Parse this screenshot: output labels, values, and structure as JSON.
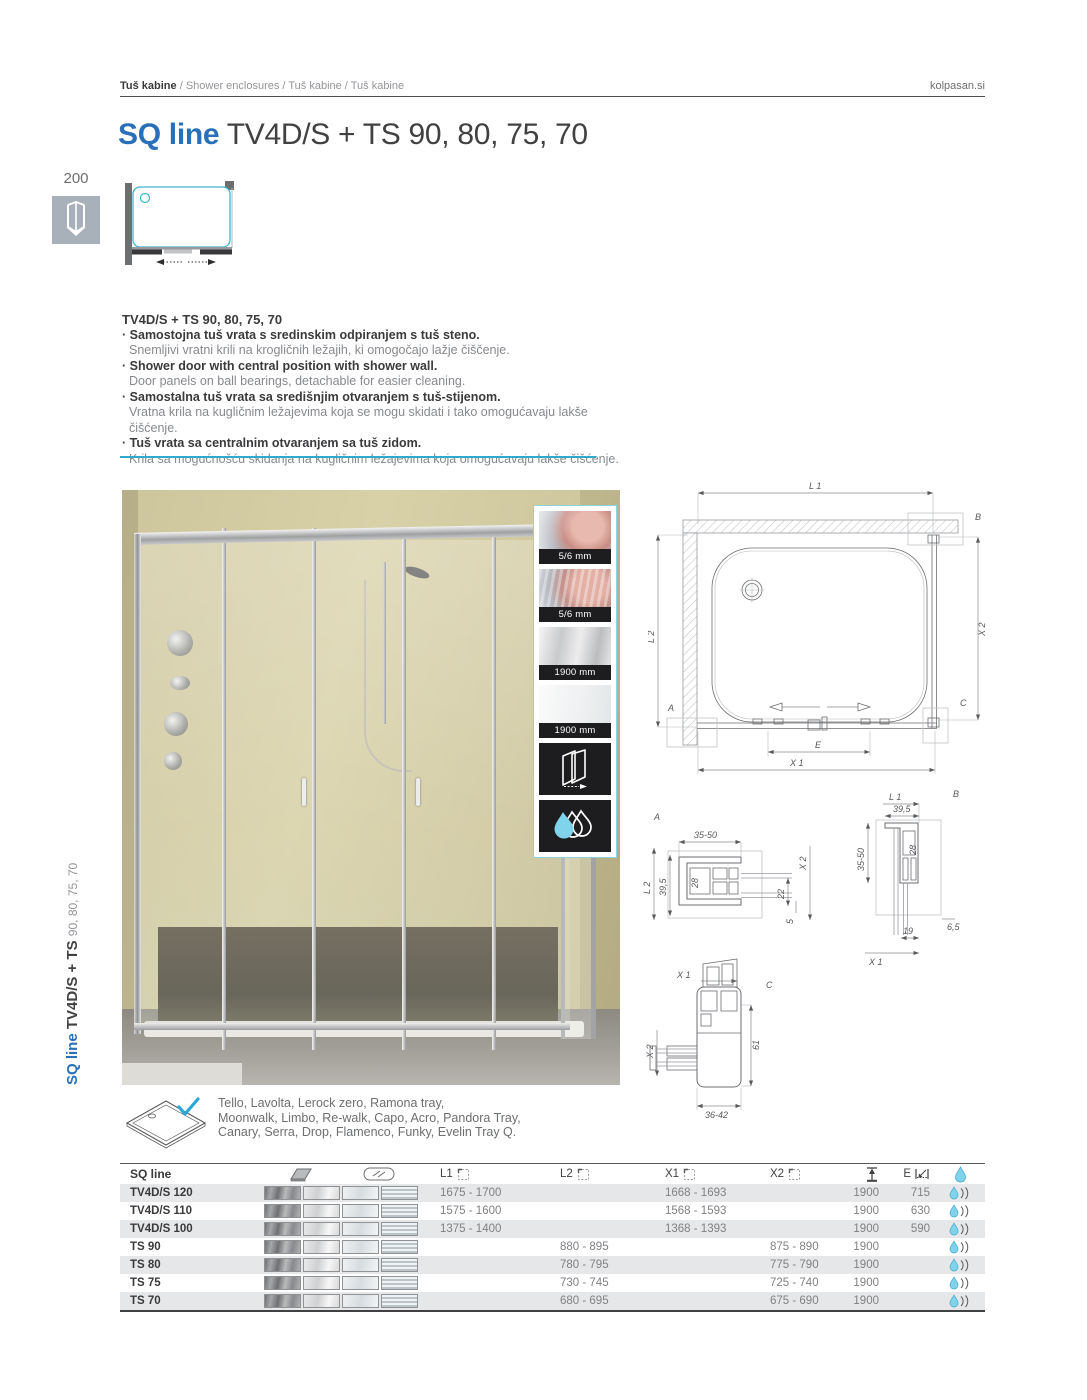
{
  "page": {
    "site": "kolpasan.si",
    "number": "200"
  },
  "breadcrumb": {
    "bold": "Tuš kabine",
    "rest": " / Shower enclosures / Tuš kabine / Tuš kabine"
  },
  "title": {
    "series": "SQ line",
    "model": "TV4D/S + TS 90, 80, 75, 70"
  },
  "side_label": {
    "series": "SQ line ",
    "model": "TV4D/S + TS ",
    "sizes": "90, 80, 75, 70"
  },
  "description": {
    "heading": "TV4D/S + TS 90, 80, 75, 70",
    "bullet": "·",
    "items": [
      {
        "title": "Samostojna tuš vrata s sredinskim odpiranjem s tuš steno.",
        "sub": "Snemljivi vratni krili na krogličnih ležajih, ki omogočajo lažje čiščenje."
      },
      {
        "title": "Shower door with central position with shower wall.",
        "sub": "Door panels on ball bearings, detachable for easier cleaning."
      },
      {
        "title": "Samostalna tuš vrata sa središnjim otvaranjem s tuš-stijenom.",
        "sub": "Vratna krila na kugličnim ležajevima koja se mogu skidati i tako omogućavaju lakše čišćenje."
      },
      {
        "title": "Tuš vrata sa centralnim otvaranjem sa tuš zidom.",
        "sub": "Krila sa mogućnošću skidanja na kugličnim ležajevima koja omogućavaju lakše čišćenje."
      }
    ]
  },
  "features": {
    "tiles": [
      {
        "label": "5/6 mm"
      },
      {
        "label": "5/6 mm"
      },
      {
        "label": "1900 mm"
      },
      {
        "label": "1900 mm"
      }
    ]
  },
  "plan": {
    "l1": "L 1",
    "l2": "L 2",
    "x1": "X 1",
    "x2": "X 2",
    "e": "E",
    "a": "A",
    "b": "B",
    "c": "C"
  },
  "detail_a": {
    "label": "A",
    "dim_top": "35-50",
    "dim_outer_left": "L 2",
    "dim_left": "39,5",
    "dim_inner": "28",
    "dim_right": "22",
    "dim_bottom": "5",
    "axis": "X 2"
  },
  "detail_b": {
    "label": "B",
    "axis_top": "L 1",
    "dim_top": "39,5",
    "dim_inner": "28",
    "dim_left": "35-50",
    "dim_right": "6,5",
    "dim_bottom": "19",
    "axis_bottom": "X 1"
  },
  "detail_c": {
    "label": "C",
    "axis_top": "X 1",
    "axis_left": "X 2",
    "dim_right": "61",
    "dim_bottom": "36-42"
  },
  "tray_note": {
    "lines": [
      "Tello, Lavolta, Lerock zero, Ramona tray,",
      "Moonwalk, Limbo, Re-walk, Capo, Acro, Pandora Tray,",
      "Canary, Serra, Drop, Flamenco, Funky, Evelin Tray Q."
    ]
  },
  "table": {
    "header": {
      "name": "SQ line",
      "l1": "L1",
      "l2": "L2",
      "x1": "X1",
      "x2": "X2",
      "e": "E"
    },
    "rows": [
      {
        "name": "TV4D/S 120",
        "l1": "1675 - 1700",
        "l2": "",
        "x1": "1668 - 1693",
        "x2": "",
        "h": "1900",
        "e": "715"
      },
      {
        "name": "TV4D/S 110",
        "l1": "1575 - 1600",
        "l2": "",
        "x1": "1568 - 1593",
        "x2": "",
        "h": "1900",
        "e": "630"
      },
      {
        "name": "TV4D/S 100",
        "l1": "1375 - 1400",
        "l2": "",
        "x1": "1368 - 1393",
        "x2": "",
        "h": "1900",
        "e": "590"
      },
      {
        "name": "TS 90",
        "l1": "",
        "l2": "880 - 895",
        "x1": "",
        "x2": "875 - 890",
        "h": "1900",
        "e": ""
      },
      {
        "name": "TS 80",
        "l1": "",
        "l2": "780 - 795",
        "x1": "",
        "x2": "775 - 790",
        "h": "1900",
        "e": ""
      },
      {
        "name": "TS 75",
        "l1": "",
        "l2": "730 - 745",
        "x1": "",
        "x2": "725 - 740",
        "h": "1900",
        "e": ""
      },
      {
        "name": "TS 70",
        "l1": "",
        "l2": "680 - 695",
        "x1": "",
        "x2": "675 - 690",
        "h": "1900",
        "e": ""
      }
    ]
  },
  "colors": {
    "accent_blue": "#2a70b9",
    "accent_cyan": "#2fa9cc",
    "drop_fill": "#7fd3ea"
  }
}
